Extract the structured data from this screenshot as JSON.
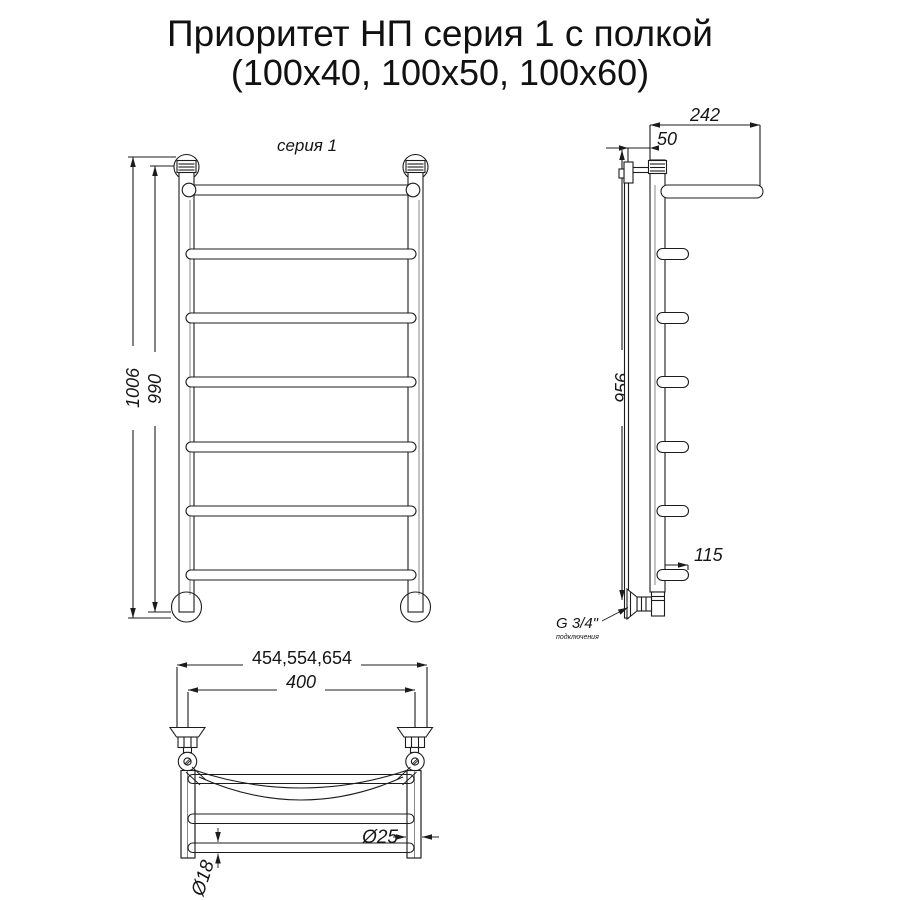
{
  "title": {
    "line1": "Приоритет НП серия 1 с полкой",
    "line2": "(100x40, 100x50, 100x60)"
  },
  "front_view": {
    "series_label": "серия 1",
    "height_overall": "1006",
    "height_axle": "990"
  },
  "side_view": {
    "shelf_depth": "242",
    "wall_offset": "50",
    "height": "956",
    "bottom_depth": "115",
    "thread": "G 3/4\"",
    "thread_note": "подключения"
  },
  "top_view": {
    "width_variants": "454,554,654",
    "mount_spacing": "400",
    "tube_main": "Ø25",
    "tube_rung": "Ø18"
  },
  "colors": {
    "line": "#1c1c1c",
    "background": "#ffffff"
  }
}
